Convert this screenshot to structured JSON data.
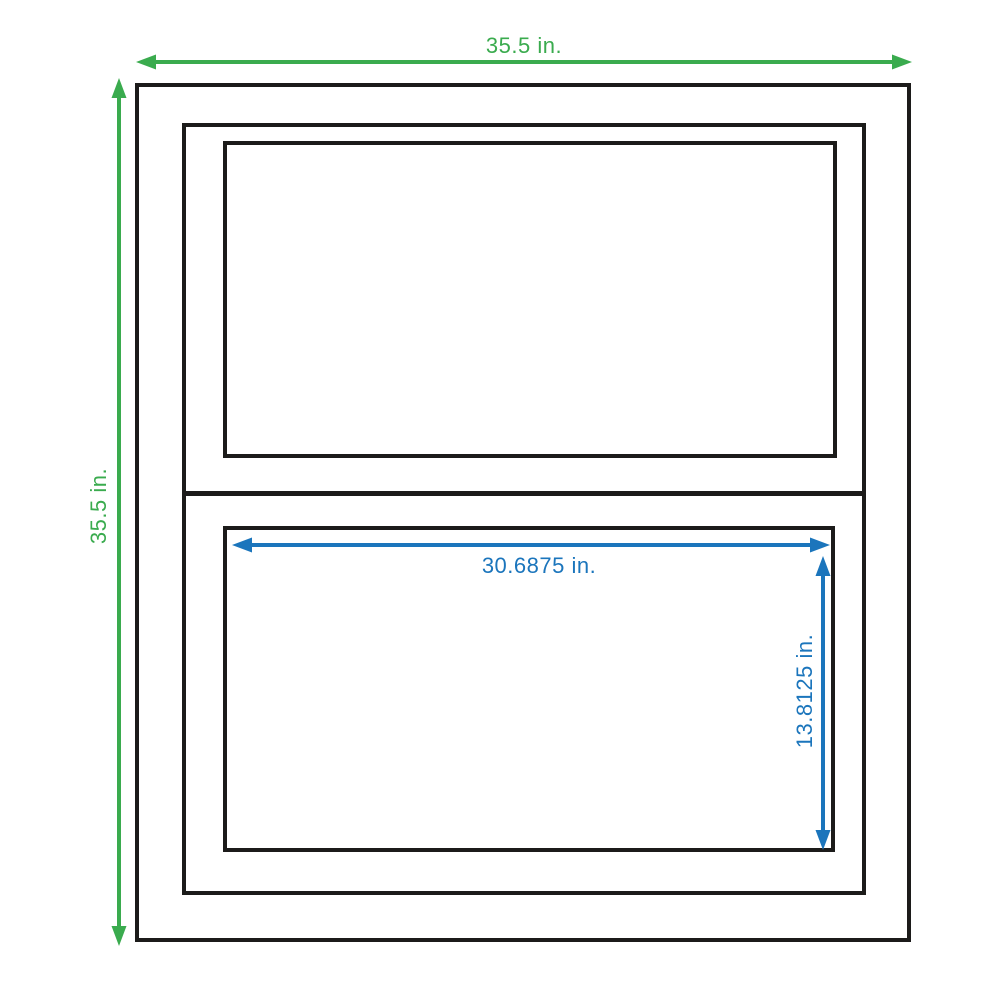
{
  "dimensions": {
    "frame_width": {
      "value": 35.5,
      "unit": "in",
      "label": "35.5 in.",
      "color": "#3aab4e"
    },
    "frame_height": {
      "value": 35.5,
      "unit": "in",
      "label": "35.5 in.",
      "color": "#3aab4e"
    },
    "glass_width": {
      "value": 30.6875,
      "unit": "in",
      "label": "30.6875 in.",
      "color": "#1b75bc"
    },
    "glass_height": {
      "value": 13.8125,
      "unit": "in",
      "label": "13.8125 in.",
      "color": "#1b75bc"
    }
  },
  "colors": {
    "frame_outline": "#1c1b1a",
    "dimension_green": "#3aab4e",
    "dimension_blue": "#1b75bc",
    "background": "#ffffff"
  }
}
